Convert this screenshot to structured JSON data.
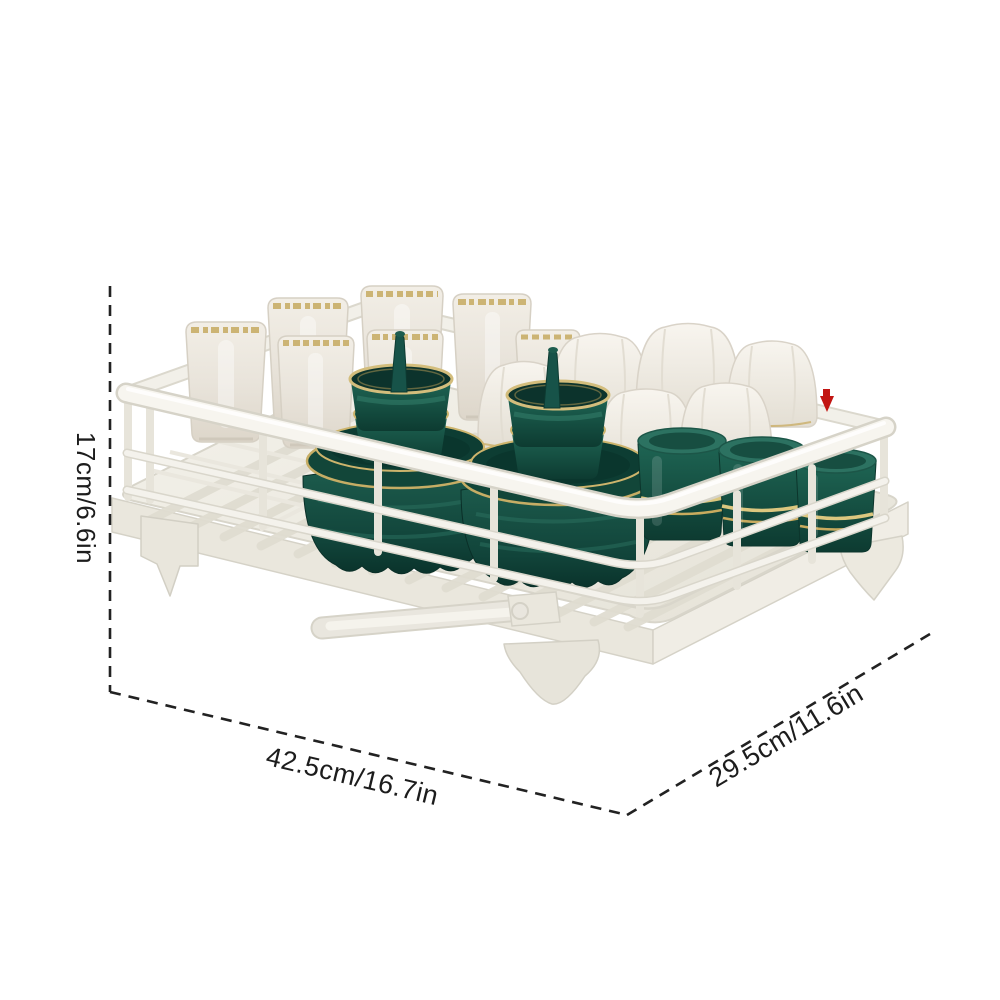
{
  "image": {
    "kind": "product dimension photo",
    "background": "#ffffff"
  },
  "dimension_annotations": {
    "height_label": "17cm/6.6in",
    "width_label": "42.5cm/16.7in",
    "depth_label": "29.5cm/11.6in",
    "line_style": "dashed",
    "line_color": "#222222"
  },
  "marker": {
    "name": "red-pin-marker",
    "color": "#c21512"
  },
  "product_scene": {
    "rack_color": "#f6f4ee",
    "tray_color": "#efede5",
    "items": [
      {
        "name": "drain-tray-with-spout",
        "color": "#efede5"
      },
      {
        "name": "wire-basket",
        "color": "#f6f4ee"
      },
      {
        "name": "white-cups-gold-rim",
        "count": 7,
        "color": "#e9e4db",
        "trim": "#c9ae68"
      },
      {
        "name": "white-lotus-bowls",
        "count": 6,
        "color": "#f2efe8"
      },
      {
        "name": "green-dish-stacks-with-spoons",
        "count": 2,
        "color": "#17574a",
        "trim": "#cdb46c"
      },
      {
        "name": "green-cups-gold-band",
        "count": 3,
        "color": "#175a4c",
        "trim": "#dcc77f"
      }
    ]
  }
}
